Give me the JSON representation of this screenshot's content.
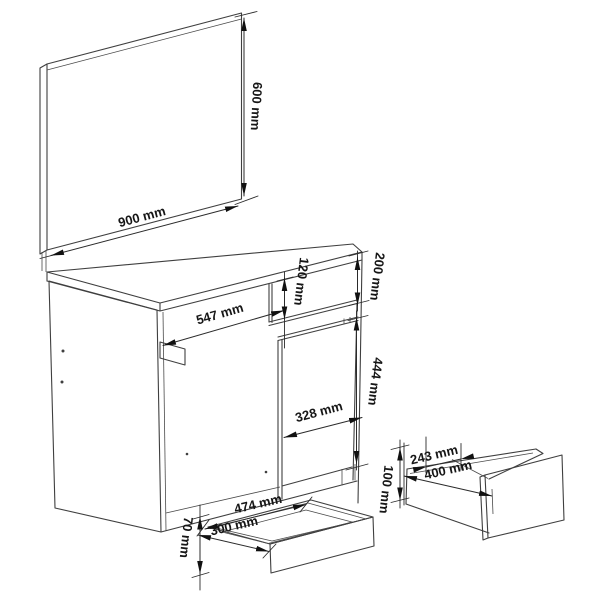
{
  "drawing": {
    "background": "#ffffff",
    "line_color": "#3f3f3f",
    "text_color": "#161616",
    "labels": {
      "mirror_height": "600 mm",
      "mirror_width": "900 mm",
      "desk_inner_width": "547 mm",
      "drawer_front_height": "120 mm",
      "top_section_height": "200 mm",
      "door_height": "444 mm",
      "door_width": "328 mm",
      "bottom_drawer_width": "474 mm",
      "bottom_drawer_depth": "300 mm",
      "bottom_drawer_height": "70 mm",
      "side_drawer_depth": "243 mm",
      "side_drawer_width": "400 mm",
      "side_drawer_height": "100 mm"
    }
  }
}
